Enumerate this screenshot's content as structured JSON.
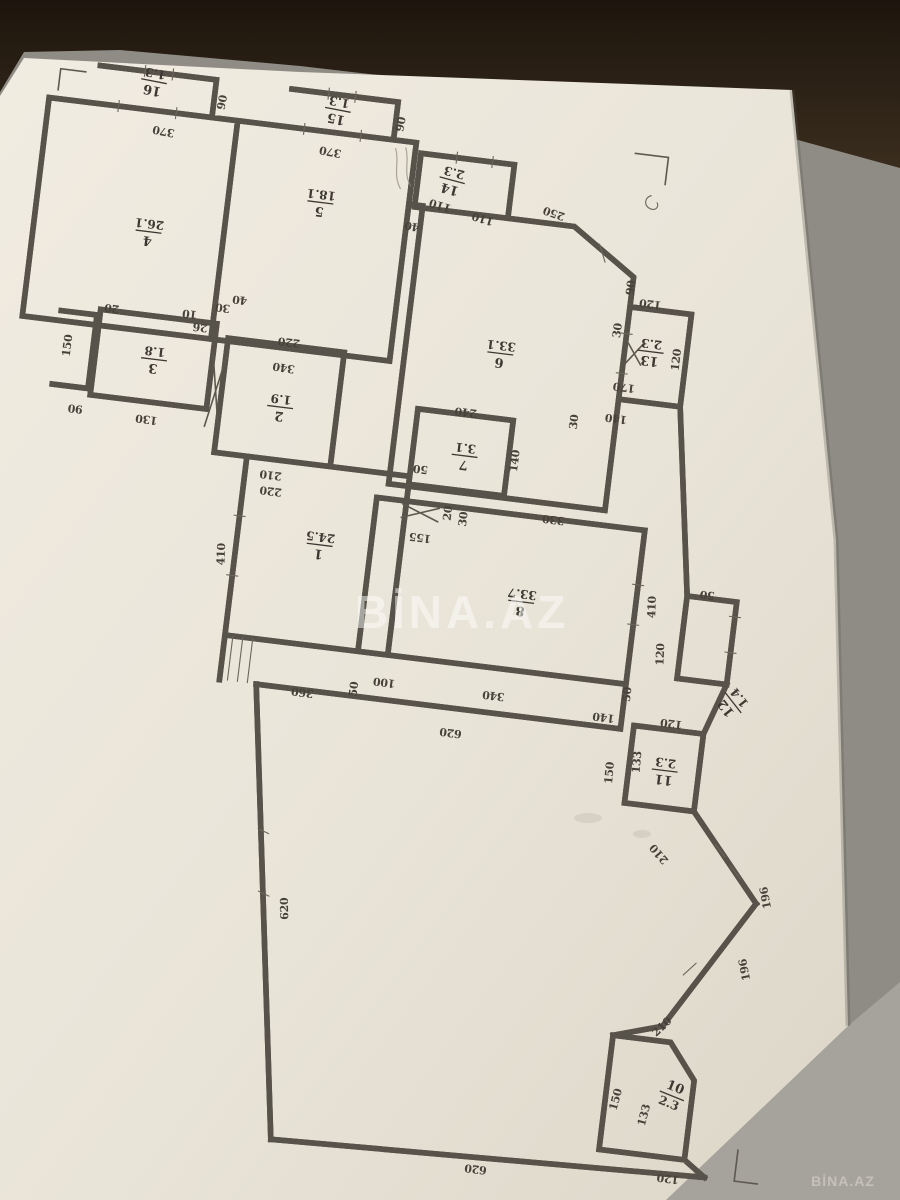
{
  "watermark": {
    "center": "BİNA.AZ",
    "corner": "BİNA.AZ"
  },
  "colors": {
    "paper": "#ece7db",
    "paper_edge": "#d7d1c3",
    "ink": "#46423a",
    "wall": "#57534a",
    "bg_top_dark": "#271d13",
    "bg_side_gray": "#8f8c86",
    "bg_corner_light": "#a6a39c",
    "watermark": "#ffffff"
  },
  "plan": {
    "rooms": [
      {
        "num": "1",
        "area": "24.5",
        "x": 371,
        "y": 500,
        "r": 180
      },
      {
        "num": "2",
        "area": "1.9",
        "x": 315,
        "y": 368,
        "r": 180
      },
      {
        "num": "3",
        "area": "1.8",
        "x": 184,
        "y": 336,
        "r": 180
      },
      {
        "num": "4",
        "area": "26.1",
        "x": 163,
        "y": 210,
        "r": 180
      },
      {
        "num": "5",
        "area": "18.1",
        "x": 330,
        "y": 160,
        "r": 180
      },
      {
        "num": "6",
        "area": "33.1",
        "x": 527,
        "y": 288,
        "r": 180
      },
      {
        "num": "7",
        "area": "3.1",
        "x": 504,
        "y": 394,
        "r": 180
      },
      {
        "num": "8",
        "area": "33.7",
        "x": 578,
        "y": 532,
        "r": 180
      },
      {
        "num": "10",
        "area": "2.3",
        "x": 788,
        "y": 1002,
        "r": 15
      },
      {
        "num": "11",
        "area": "2.3",
        "x": 741,
        "y": 682,
        "r": 180
      },
      {
        "num": "12",
        "area": "1.4",
        "x": 800,
        "y": 606,
        "r": 225
      },
      {
        "num": "13",
        "area": "2.3",
        "x": 676,
        "y": 268,
        "r": 180
      },
      {
        "num": "14",
        "area": "2.3",
        "x": 458,
        "y": 122,
        "r": 188
      },
      {
        "num": "15",
        "area": "1.3",
        "x": 336,
        "y": 66,
        "r": 184
      },
      {
        "num": "16",
        "area": "1.3",
        "x": 150,
        "y": 60,
        "r": 184
      }
    ],
    "dims": [
      {
        "t": "370",
        "x": 166,
        "y": 104,
        "r": 184
      },
      {
        "t": "90",
        "x": 224,
        "y": 72,
        "r": 274
      },
      {
        "t": "370",
        "x": 334,
        "y": 104,
        "r": 184
      },
      {
        "t": "90",
        "x": 404,
        "y": 72,
        "r": 274
      },
      {
        "t": "340",
        "x": 314,
        "y": 324,
        "r": 182
      },
      {
        "t": "110",
        "x": 450,
        "y": 144,
        "r": 190
      },
      {
        "t": "110",
        "x": 494,
        "y": 152,
        "r": 190
      },
      {
        "t": "40",
        "x": 424,
        "y": 168,
        "r": 184
      },
      {
        "t": "250",
        "x": 564,
        "y": 138,
        "r": 192
      },
      {
        "t": "90",
        "x": 652,
        "y": 206,
        "r": 270
      },
      {
        "t": "120",
        "x": 670,
        "y": 216,
        "r": 180
      },
      {
        "t": "30",
        "x": 644,
        "y": 250,
        "r": 270
      },
      {
        "t": "170",
        "x": 654,
        "y": 302,
        "r": 180
      },
      {
        "t": "140",
        "x": 650,
        "y": 334,
        "r": 180
      },
      {
        "t": "30",
        "x": 612,
        "y": 346,
        "r": 270
      },
      {
        "t": "120",
        "x": 706,
        "y": 272,
        "r": 270
      },
      {
        "t": "330",
        "x": 600,
        "y": 442,
        "r": 180
      },
      {
        "t": "240",
        "x": 500,
        "y": 346,
        "r": 180
      },
      {
        "t": "140",
        "x": 558,
        "y": 392,
        "r": 270
      },
      {
        "t": "50",
        "x": 462,
        "y": 408,
        "r": 180
      },
      {
        "t": "20",
        "x": 498,
        "y": 452,
        "r": 270
      },
      {
        "t": "30",
        "x": 514,
        "y": 456,
        "r": 270
      },
      {
        "t": "155",
        "x": 470,
        "y": 476,
        "r": 180
      },
      {
        "t": "220",
        "x": 316,
        "y": 298,
        "r": 180
      },
      {
        "t": "210",
        "x": 314,
        "y": 432,
        "r": 180
      },
      {
        "t": "220",
        "x": 316,
        "y": 448,
        "r": 180
      },
      {
        "t": "130",
        "x": 184,
        "y": 392,
        "r": 180
      },
      {
        "t": "150",
        "x": 100,
        "y": 332,
        "r": 270
      },
      {
        "t": "90",
        "x": 112,
        "y": 390,
        "r": 180
      },
      {
        "t": "20",
        "x": 136,
        "y": 286,
        "r": 180
      },
      {
        "t": "10",
        "x": 214,
        "y": 282,
        "r": 180
      },
      {
        "t": "26",
        "x": 226,
        "y": 294,
        "r": 180
      },
      {
        "t": "30",
        "x": 246,
        "y": 272,
        "r": 180
      },
      {
        "t": "40",
        "x": 262,
        "y": 262,
        "r": 180
      },
      {
        "t": "410",
        "x": 278,
        "y": 520,
        "r": 265
      },
      {
        "t": "360",
        "x": 372,
        "y": 644,
        "r": 180
      },
      {
        "t": "100",
        "x": 452,
        "y": 624,
        "r": 180
      },
      {
        "t": "340",
        "x": 562,
        "y": 624,
        "r": 180
      },
      {
        "t": "140",
        "x": 674,
        "y": 632,
        "r": 180
      },
      {
        "t": "50",
        "x": 426,
        "y": 638,
        "r": 270
      },
      {
        "t": "50",
        "x": 698,
        "y": 610,
        "r": 270
      },
      {
        "t": "620",
        "x": 524,
        "y": 666,
        "r": 180
      },
      {
        "t": "410",
        "x": 712,
        "y": 520,
        "r": 265
      },
      {
        "t": "120",
        "x": 726,
        "y": 566,
        "r": 265
      },
      {
        "t": "50",
        "x": 762,
        "y": 498,
        "r": 180
      },
      {
        "t": "120",
        "x": 742,
        "y": 630,
        "r": 180
      },
      {
        "t": "133",
        "x": 716,
        "y": 676,
        "r": 268
      },
      {
        "t": "150",
        "x": 690,
        "y": 690,
        "r": 268
      },
      {
        "t": "210",
        "x": 748,
        "y": 762,
        "r": 222
      },
      {
        "t": "196",
        "x": 860,
        "y": 794,
        "r": 252
      },
      {
        "t": "196",
        "x": 848,
        "y": 868,
        "r": 252
      },
      {
        "t": "210",
        "x": 772,
        "y": 938,
        "r": 310
      },
      {
        "t": "133",
        "x": 766,
        "y": 1026,
        "r": 278
      },
      {
        "t": "150",
        "x": 736,
        "y": 1014,
        "r": 278
      },
      {
        "t": "120",
        "x": 794,
        "y": 1082,
        "r": 180
      },
      {
        "t": "620",
        "x": 384,
        "y": 864,
        "r": 262
      },
      {
        "t": "620",
        "x": 602,
        "y": 1096,
        "r": 180
      }
    ]
  }
}
